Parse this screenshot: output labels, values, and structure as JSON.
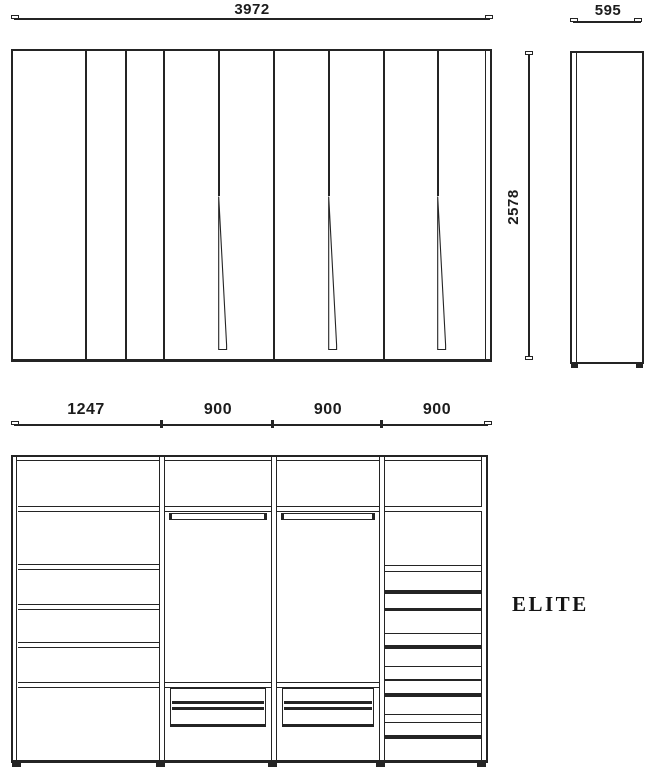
{
  "views": {
    "front": {
      "width_dim": "3972",
      "height_dim": "2578"
    },
    "side": {
      "width_dim": "595"
    },
    "internal": {
      "section_dims": [
        "1247",
        "900",
        "900",
        "900"
      ]
    }
  },
  "brand": {
    "name": "ELITE"
  },
  "style": {
    "line_color": "#242424",
    "background": "#ffffff"
  }
}
